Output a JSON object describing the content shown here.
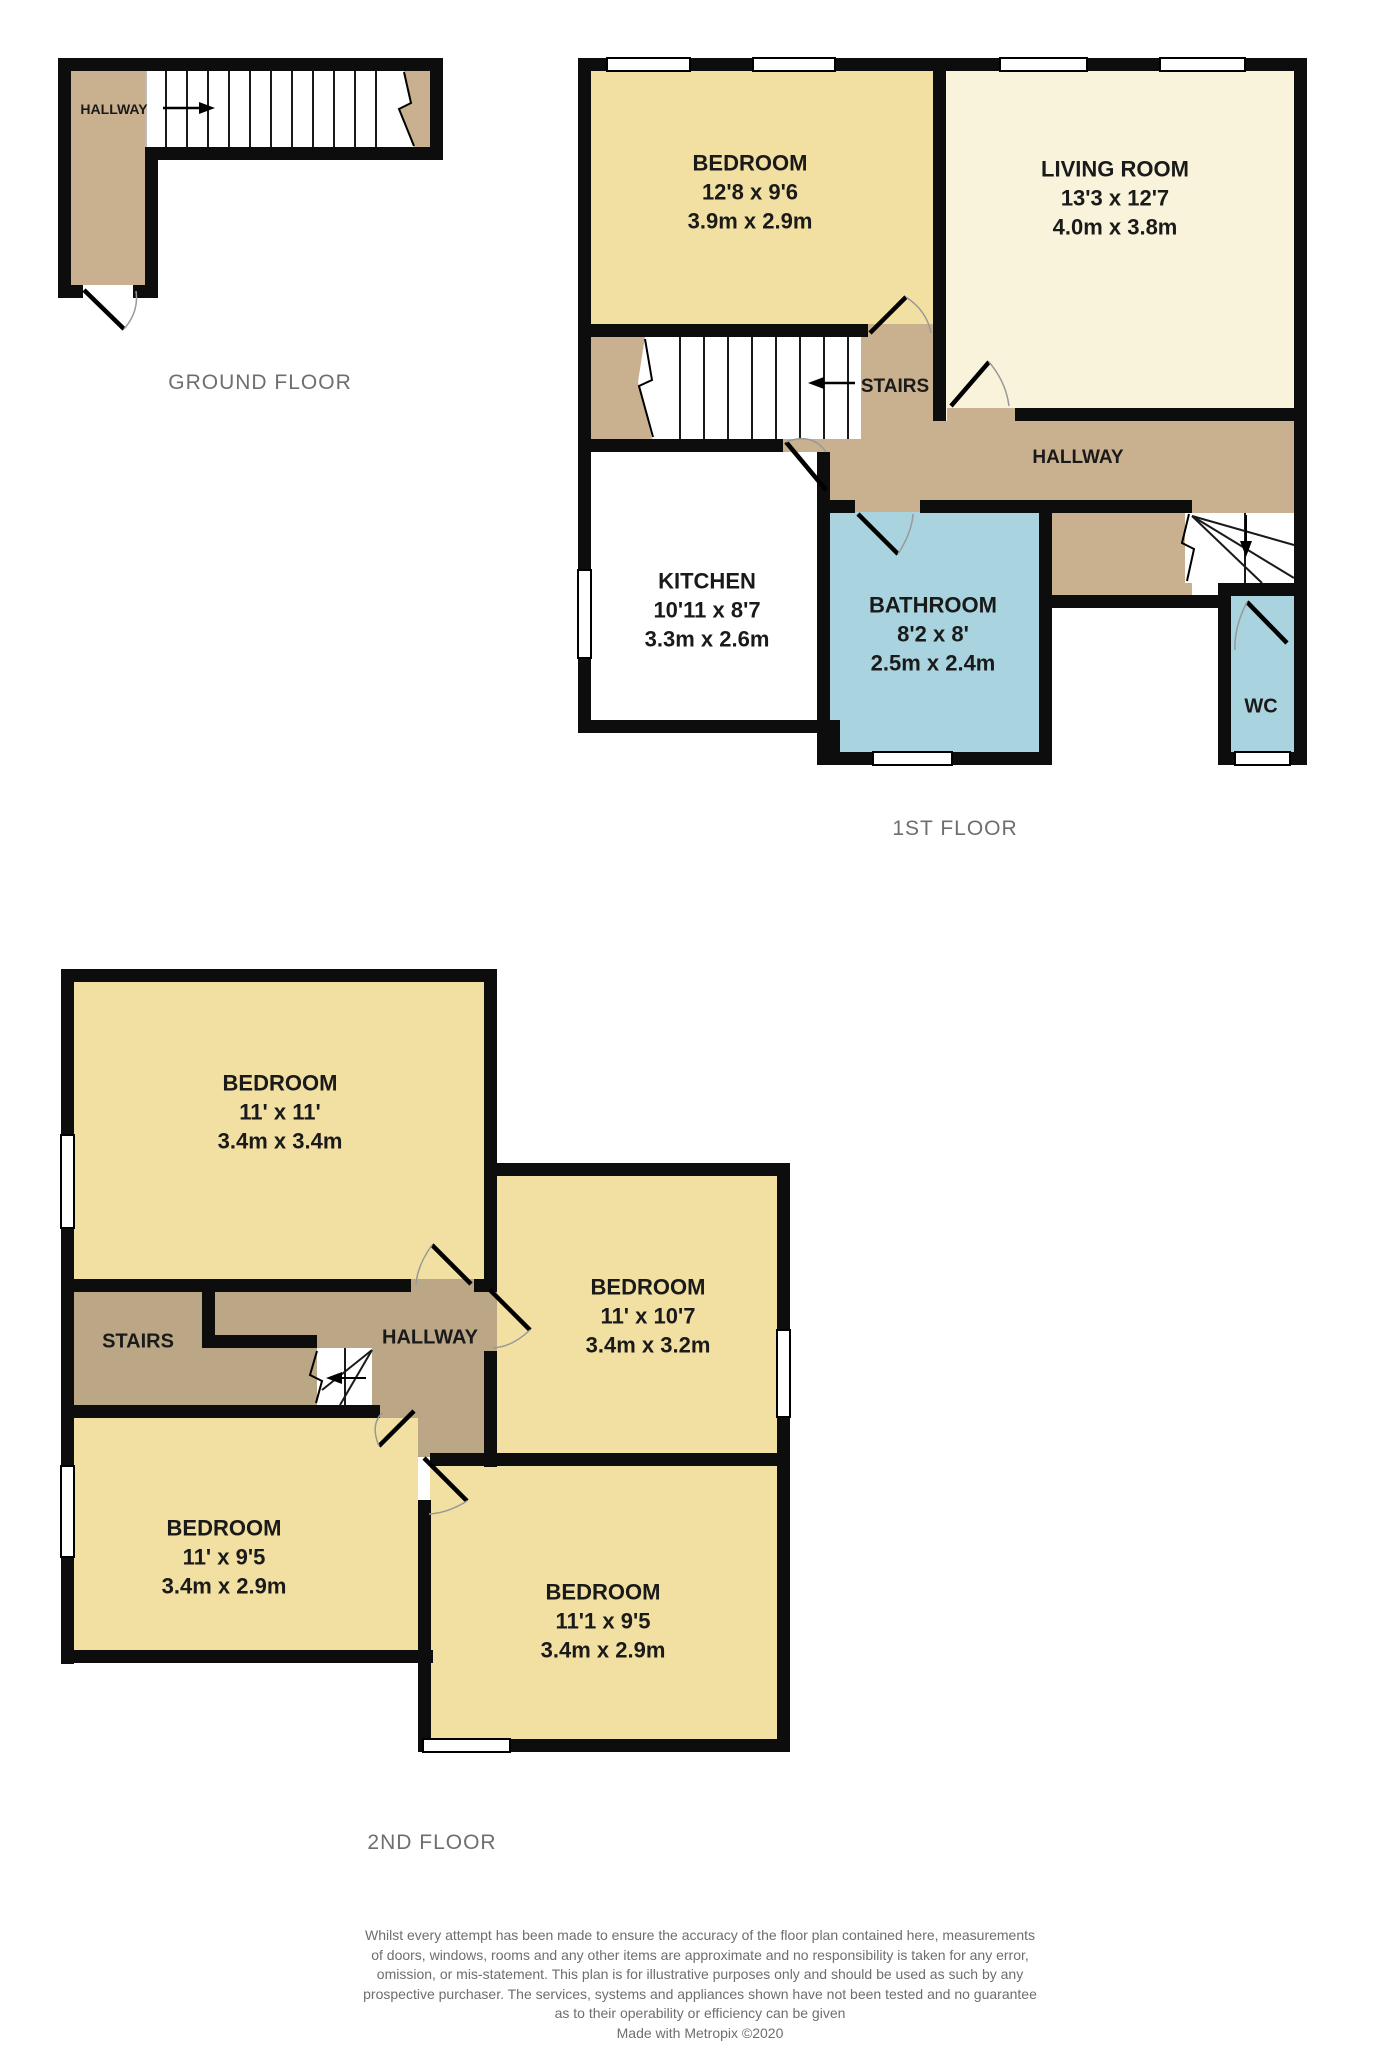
{
  "colors": {
    "room_yellow": "#f2e0a2",
    "room_cream": "#f8f3da",
    "hallway_tan": "#c9b08e",
    "hallway_tan_dark": "#bba686",
    "bathroom_blue": "#a9d3de",
    "wall_black": "#0d0d0d",
    "label_gray": "#6e6e6e",
    "room_text": "#1a1a1a"
  },
  "ground_floor": {
    "title": "GROUND FLOOR",
    "hallway_label": "HALLWAY"
  },
  "first_floor": {
    "title": "1ST FLOOR",
    "stairs_label": "STAIRS",
    "hallway_label": "HALLWAY",
    "wc_label": "WC",
    "bedroom": {
      "name": "BEDROOM",
      "size_imperial": "12'8 x 9'6",
      "size_metric": "3.9m x 2.9m"
    },
    "living_room": {
      "name": "LIVING ROOM",
      "size_imperial": "13'3 x 12'7",
      "size_metric": "4.0m x 3.8m"
    },
    "kitchen": {
      "name": "KITCHEN",
      "size_imperial": "10'11 x 8'7",
      "size_metric": "3.3m x 2.6m"
    },
    "bathroom": {
      "name": "BATHROOM",
      "size_imperial": "8'2 x 8'",
      "size_metric": "2.5m x 2.4m"
    }
  },
  "second_floor": {
    "title": "2ND FLOOR",
    "stairs_label": "STAIRS",
    "hallway_label": "HALLWAY",
    "bedroom_top": {
      "name": "BEDROOM",
      "size_imperial": "11' x 11'",
      "size_metric": "3.4m x 3.4m"
    },
    "bedroom_right": {
      "name": "BEDROOM",
      "size_imperial": "11' x 10'7",
      "size_metric": "3.4m x 3.2m"
    },
    "bedroom_left": {
      "name": "BEDROOM",
      "size_imperial": "11' x 9'5",
      "size_metric": "3.4m x 2.9m"
    },
    "bedroom_bottom": {
      "name": "BEDROOM",
      "size_imperial": "11'1 x 9'5",
      "size_metric": "3.4m x 2.9m"
    }
  },
  "footer": {
    "disclaimer_lines": [
      "Whilst every attempt has been made to ensure the accuracy of the floor plan contained here, measurements",
      "of doors, windows, rooms and any other items are approximate and no responsibility is taken for any error,",
      "omission, or mis-statement. This plan is for illustrative purposes only and should be used as such by any",
      "prospective purchaser. The services, systems and appliances shown have not been tested and no guarantee",
      "as to their operability or efficiency can be given",
      "Made with Metropix ©2020"
    ]
  }
}
